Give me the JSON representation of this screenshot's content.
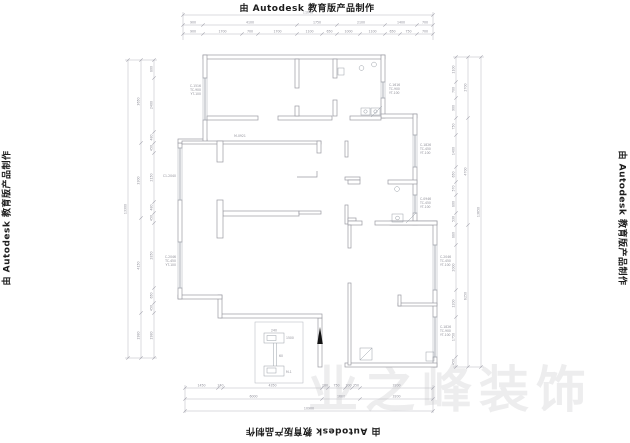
{
  "watermark": {
    "autodesk": "由 Autodesk 教育版产品制作",
    "brand": "业之峰装饰"
  },
  "colors": {
    "wall": "#9a9aa2",
    "dimension": "#b7b7bf",
    "label": "#90909a",
    "arrow": "#141414",
    "background": "#ffffff"
  },
  "tags": {
    "t1": [
      "C-1516",
      "TC-900",
      "YT-100"
    ],
    "t2": "C1-2040",
    "t3": [
      "C-2046",
      "TC-450",
      "YT-100"
    ],
    "t4": [
      "C-1616",
      "TC-900",
      "YT-100"
    ],
    "t5": [
      "C-1826",
      "TC-450",
      "YT-100"
    ],
    "t6": [
      "C-0946",
      "TC-450",
      "YT-100"
    ],
    "t7": [
      "C-2046",
      "TC-450",
      "YT-100"
    ],
    "t8": [
      "C-1826",
      "TC-900",
      "YT-100"
    ],
    "door": "M-0921",
    "marker_width": "240",
    "marker_top": "1500",
    "marker_mid": "60",
    "marker_bottom": "M-1"
  },
  "dimensions": {
    "top": {
      "overall": "11040",
      "mid": [
        "900",
        "4100",
        "1750",
        "2100",
        "1400",
        "700"
      ],
      "inner": [
        "900",
        "1700",
        "700",
        "1700",
        "1100",
        "650",
        "1000",
        "1100",
        "650",
        "750",
        "700"
      ]
    },
    "bottom": {
      "inner": [
        "1450",
        "240",
        "4350",
        "280",
        "750",
        "300",
        "350",
        "3200"
      ],
      "mid": [
        "6000",
        "1680",
        "3200"
      ],
      "overall": "10900"
    },
    "left": {
      "overall": "13300",
      "mid": [
        "3650",
        "3300",
        "4150",
        "1980"
      ],
      "inner": [
        "800",
        "2400",
        "480",
        "450",
        "2150",
        "480",
        "450",
        "2850",
        "650",
        "450",
        "1980"
      ]
    },
    "right": {
      "inner": [
        "1100",
        "700",
        "900",
        "750",
        "1400",
        "650",
        "570",
        "800",
        "530",
        "880",
        "2000",
        "1200",
        "1750",
        "450"
      ],
      "mid": [
        "2700",
        "4700",
        "6250"
      ],
      "overall": "13650"
    }
  }
}
